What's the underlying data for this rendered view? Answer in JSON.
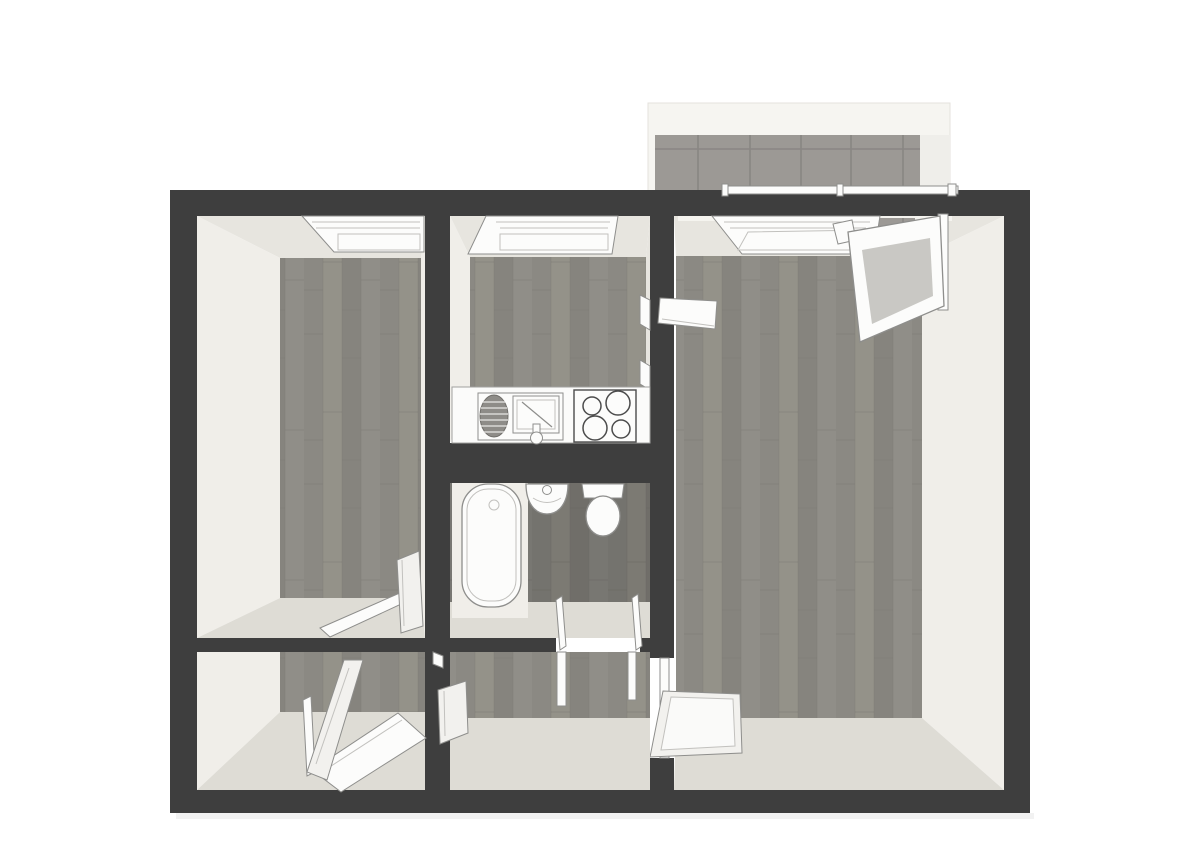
{
  "scene": {
    "title": "apartment-floor-plan-3d-top-view",
    "description": "Top-down 3D rendered floor plan: two rooms, kitchen, bathroom, hallway and tiled balcony",
    "visible_text": ""
  },
  "colors": {
    "canvas_bg": "#ffffff",
    "wall": "#3e3e3e",
    "skirt_light": "#f0eee9",
    "skirt_mid": "#e7e5df",
    "skirt_shadow": "#dedcd5",
    "wood1": "#8b8983",
    "wood2": "#949289",
    "wood3": "#86847e",
    "wood4": "#908e88",
    "wood_seam": "#7b7974",
    "fixture_fill": "#fcfcfb",
    "fixture_stroke": "#8e8e8c",
    "frame_soft": "#c2c1be",
    "glass": "#c9c8c4",
    "tile": "#9c9995",
    "tile_grout": "#898683",
    "balcony_bg": "#f6f5f1",
    "balcony_side": "#efeeea",
    "balcony_edge": "#e4e2dd",
    "counter_fill": "#fbfbfa",
    "counter_stroke": "#a0a09e",
    "appliance_dark": "#8e8c88",
    "appliance_edge": "#6f6d69",
    "appliance_stripe": "#d9d8d5",
    "stove_stroke": "#4c4c4c",
    "door_leaf": "#f2f1ee",
    "door_inner": "#fafaf9"
  },
  "rooms": [
    {
      "id": "bedroom-left",
      "kind": "room",
      "floor": "wood",
      "features": [
        "window-top-wall",
        "open-door"
      ]
    },
    {
      "id": "kitchen",
      "kind": "kitchen",
      "floor": "wood",
      "features": [
        "window-top-wall",
        "counter",
        "dish-drainer",
        "sink",
        "stove-cooktop",
        "door-to-living-room"
      ]
    },
    {
      "id": "bathroom",
      "kind": "bathroom",
      "floor": "wood-dark",
      "features": [
        "bathtub",
        "washbasin",
        "toilet",
        "door-to-hallway"
      ]
    },
    {
      "id": "living-room",
      "kind": "living-room",
      "floor": "wood",
      "features": [
        "window-top-wall",
        "open-balcony-door",
        "open-door-to-hallway",
        "open-door-to-kitchen"
      ]
    },
    {
      "id": "bedroom-bottom-left",
      "kind": "room",
      "floor": "wood",
      "features": [
        "open-window-bottom-wall",
        "open-door"
      ]
    },
    {
      "id": "hallway",
      "kind": "hallway",
      "floor": "wood",
      "features": [
        "door-frames"
      ]
    },
    {
      "id": "balcony",
      "kind": "balcony",
      "floor": "tile",
      "features": [
        "railing"
      ]
    }
  ]
}
